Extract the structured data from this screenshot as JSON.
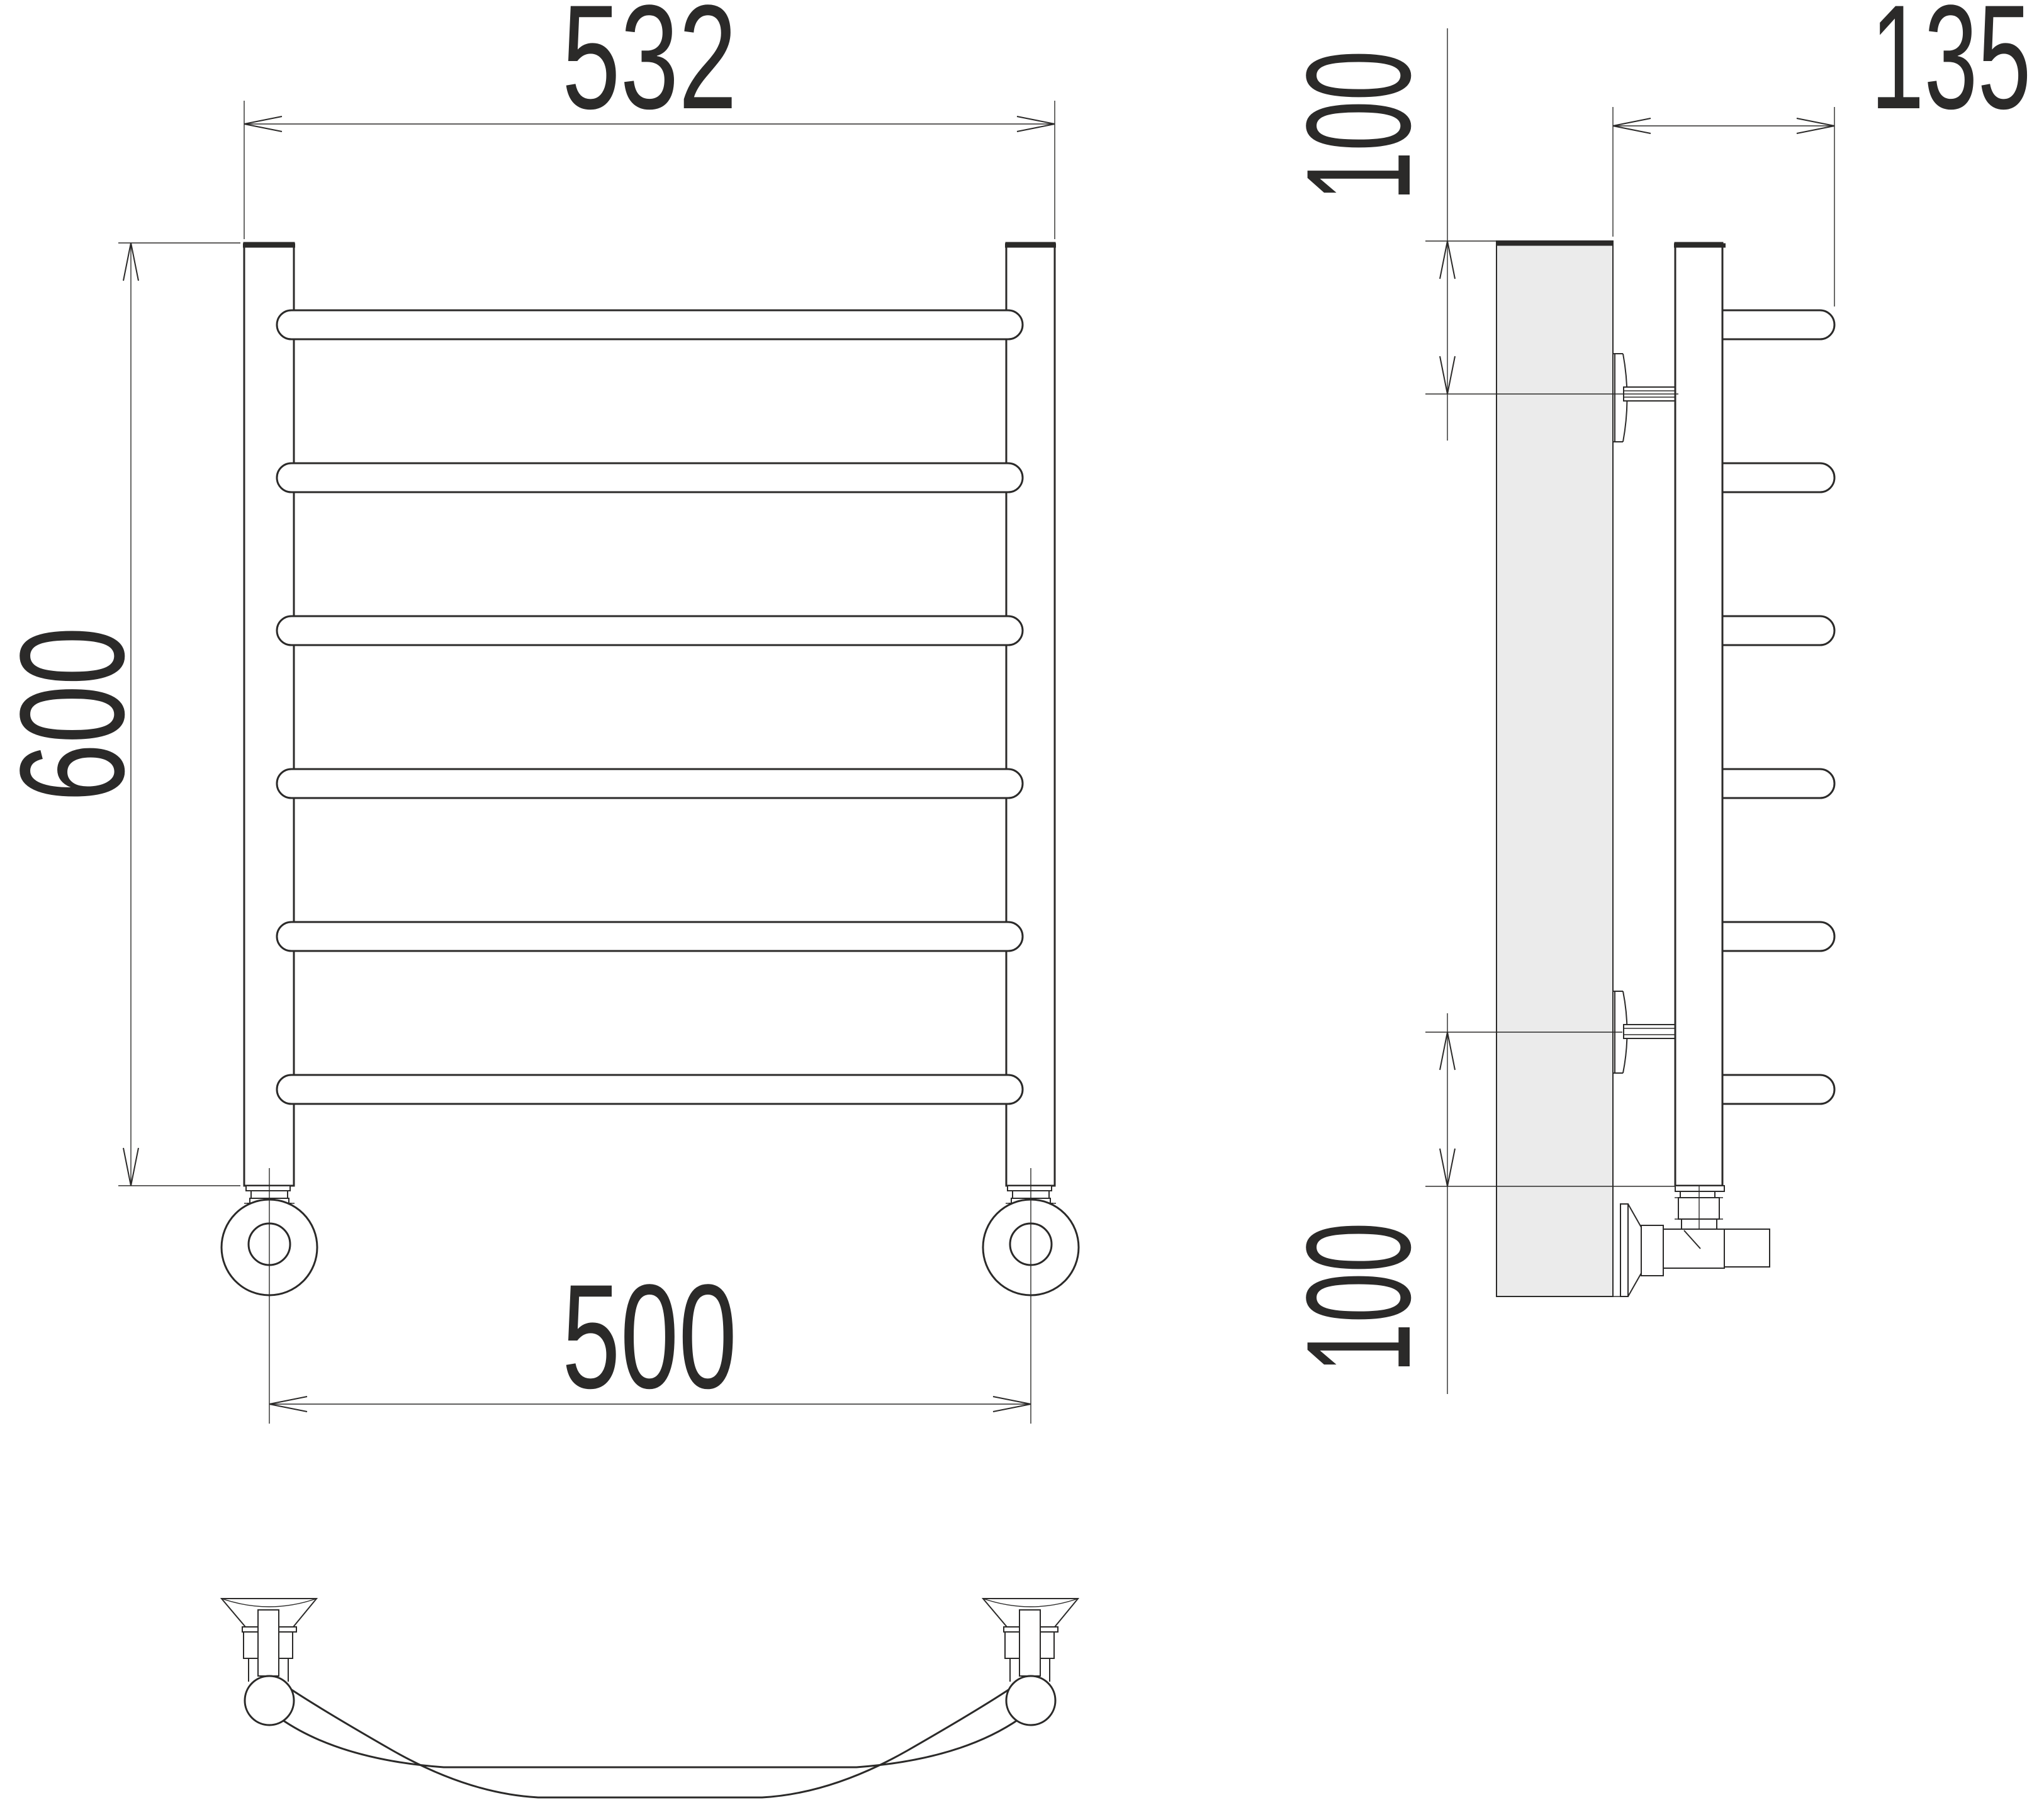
{
  "drawing": {
    "title": "Ladder towel radiator – dimensional drawing",
    "views": {
      "front": "front view",
      "side": "side view",
      "top": "top view"
    },
    "rung_count": 6,
    "colors": {
      "line": "#2b2a29",
      "wall_fill": "#ebebeb",
      "background": "#ffffff"
    },
    "dimensions": {
      "overall_width": {
        "value": "532",
        "view": "front",
        "meaning": "overall width over the two stands"
      },
      "overall_height": {
        "value": "600",
        "view": "front",
        "meaning": "height of the stands"
      },
      "connection_spacing": {
        "value": "500",
        "view": "front",
        "meaning": "centre distance of bottom connections"
      },
      "depth": {
        "value": "135",
        "view": "side",
        "meaning": "distance from wall face to front of rungs"
      },
      "top_bracket_offset": {
        "value": "100",
        "view": "side",
        "meaning": "top of stand to upper bracket axis"
      },
      "bottom_bracket_offset": {
        "value": "100",
        "view": "side",
        "meaning": "lower bracket axis to bottom of stand"
      }
    }
  }
}
